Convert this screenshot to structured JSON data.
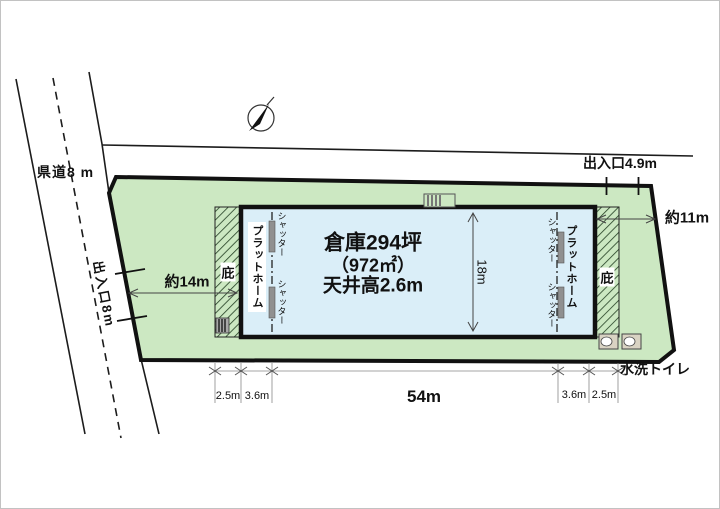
{
  "plan": {
    "road_label": "県道8 m",
    "west_entrance": "出入口8m",
    "north_entrance": "出入口4.9m",
    "west_clearance": "約14m",
    "east_clearance": "約11m",
    "building": {
      "line1": "倉庫294坪",
      "line2": "（972㎡）",
      "line3": "天井高2.6m",
      "depth": "18m",
      "eaves_label": "庇",
      "platform_label": "プラットホーム",
      "shutter_label": "シャッター"
    },
    "bottom_dimensions": [
      "2.5m",
      "3.6m",
      "54m",
      "3.6m",
      "2.5m"
    ],
    "toilet_label": "水洗トイレ",
    "colors": {
      "site_green": "#cce8c2",
      "building_blue": "#daeef8",
      "hatch_line": "#233f23",
      "outline_black": "#111111"
    }
  }
}
